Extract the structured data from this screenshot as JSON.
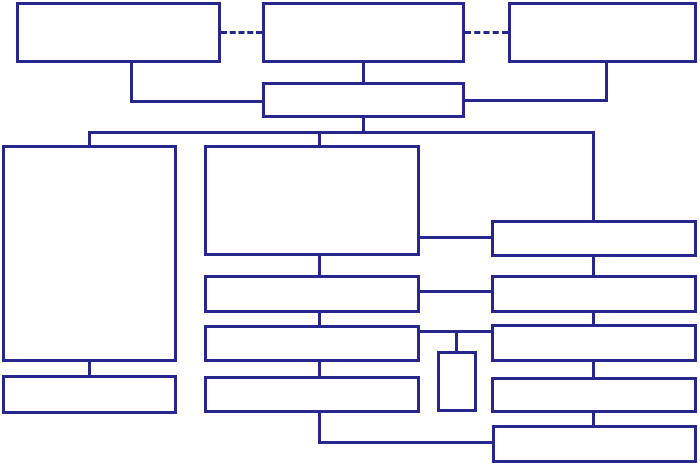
{
  "diagram": {
    "title": "flowchart-with-empty-boxes",
    "canvas": {
      "width": 700,
      "height": 465,
      "background": "#ffffff"
    },
    "stroke_color": "#26268c",
    "stroke_width": 3,
    "nodes": [
      {
        "id": "top-left",
        "x": 16,
        "y": 2,
        "w": 205,
        "h": 61
      },
      {
        "id": "top-middle",
        "x": 262,
        "y": 2,
        "w": 203,
        "h": 61
      },
      {
        "id": "top-right",
        "x": 508,
        "y": 2,
        "w": 189,
        "h": 61
      },
      {
        "id": "level2-hub",
        "x": 262,
        "y": 82,
        "w": 203,
        "h": 36
      },
      {
        "id": "left-tall",
        "x": 2,
        "y": 145,
        "w": 175,
        "h": 217
      },
      {
        "id": "left-bottom",
        "x": 2,
        "y": 375,
        "w": 175,
        "h": 39
      },
      {
        "id": "mid-large",
        "x": 204,
        "y": 145,
        "w": 216,
        "h": 111
      },
      {
        "id": "mid-row-2",
        "x": 204,
        "y": 275,
        "w": 216,
        "h": 38
      },
      {
        "id": "mid-row-3",
        "x": 204,
        "y": 325,
        "w": 216,
        "h": 37
      },
      {
        "id": "mid-row-4",
        "x": 204,
        "y": 376,
        "w": 216,
        "h": 37
      },
      {
        "id": "small-vertical",
        "x": 437,
        "y": 351,
        "w": 40,
        "h": 61
      },
      {
        "id": "right-row-1",
        "x": 491,
        "y": 220,
        "w": 206,
        "h": 37
      },
      {
        "id": "right-row-2",
        "x": 491,
        "y": 275,
        "w": 206,
        "h": 38
      },
      {
        "id": "right-row-3",
        "x": 491,
        "y": 324,
        "w": 206,
        "h": 38
      },
      {
        "id": "right-row-4",
        "x": 491,
        "y": 377,
        "w": 206,
        "h": 36
      },
      {
        "id": "right-row-5",
        "x": 492,
        "y": 425,
        "w": 205,
        "h": 38
      }
    ],
    "connectors": [
      {
        "id": "dash-topleft-topmiddle",
        "type": "h-dashed",
        "x": 221,
        "y": 31,
        "len": 41
      },
      {
        "id": "dash-topmiddle-topright",
        "type": "h-dashed",
        "x": 465,
        "y": 31,
        "len": 43
      },
      {
        "id": "topleft-drop",
        "type": "v",
        "x": 130,
        "y": 63,
        "len": 40
      },
      {
        "id": "topleft-to-hub",
        "type": "h",
        "x": 130,
        "y": 100,
        "len": 132
      },
      {
        "id": "topmiddle-to-hub",
        "type": "v",
        "x": 362,
        "y": 63,
        "len": 19
      },
      {
        "id": "topright-drop",
        "type": "v",
        "x": 605,
        "y": 63,
        "len": 39
      },
      {
        "id": "topright-to-hub",
        "type": "h",
        "x": 465,
        "y": 99,
        "len": 143
      },
      {
        "id": "hub-to-bus",
        "type": "v",
        "x": 362,
        "y": 118,
        "len": 16
      },
      {
        "id": "bus",
        "type": "h",
        "x": 88,
        "y": 131,
        "len": 507
      },
      {
        "id": "bus-drop-left",
        "type": "v",
        "x": 88,
        "y": 131,
        "len": 14
      },
      {
        "id": "bus-drop-middle",
        "type": "v",
        "x": 318,
        "y": 131,
        "len": 14
      },
      {
        "id": "bus-drop-right",
        "type": "v",
        "x": 592,
        "y": 131,
        "len": 89
      },
      {
        "id": "lefttall-to-leftbottom",
        "type": "v",
        "x": 88,
        "y": 362,
        "len": 13
      },
      {
        "id": "midlarge-to-midrow2",
        "type": "v",
        "x": 318,
        "y": 256,
        "len": 19
      },
      {
        "id": "midrow2-to-midrow3",
        "type": "v",
        "x": 318,
        "y": 313,
        "len": 12
      },
      {
        "id": "midrow3-to-midrow4",
        "type": "v",
        "x": 318,
        "y": 362,
        "len": 14
      },
      {
        "id": "midrow4-drop",
        "type": "v",
        "x": 318,
        "y": 413,
        "len": 31
      },
      {
        "id": "midrow4-to-rightrow5",
        "type": "h",
        "x": 318,
        "y": 441,
        "len": 174
      },
      {
        "id": "midlarge-to-rightrow1",
        "type": "h",
        "x": 420,
        "y": 236,
        "len": 71
      },
      {
        "id": "midrow2-to-rightrow2",
        "type": "h",
        "x": 420,
        "y": 290,
        "len": 71
      },
      {
        "id": "midrow3-to-rightrow3",
        "type": "h",
        "x": 420,
        "y": 330,
        "len": 71
      },
      {
        "id": "branch-to-smallbox",
        "type": "v",
        "x": 455,
        "y": 330,
        "len": 21
      },
      {
        "id": "rightrow1-to-rightrow2",
        "type": "v",
        "x": 592,
        "y": 257,
        "len": 18
      },
      {
        "id": "rightrow2-to-rightrow3",
        "type": "v",
        "x": 592,
        "y": 313,
        "len": 11
      },
      {
        "id": "rightrow3-to-rightrow4",
        "type": "v",
        "x": 592,
        "y": 362,
        "len": 15
      },
      {
        "id": "rightrow4-to-rightrow5",
        "type": "v",
        "x": 592,
        "y": 413,
        "len": 12
      }
    ]
  }
}
